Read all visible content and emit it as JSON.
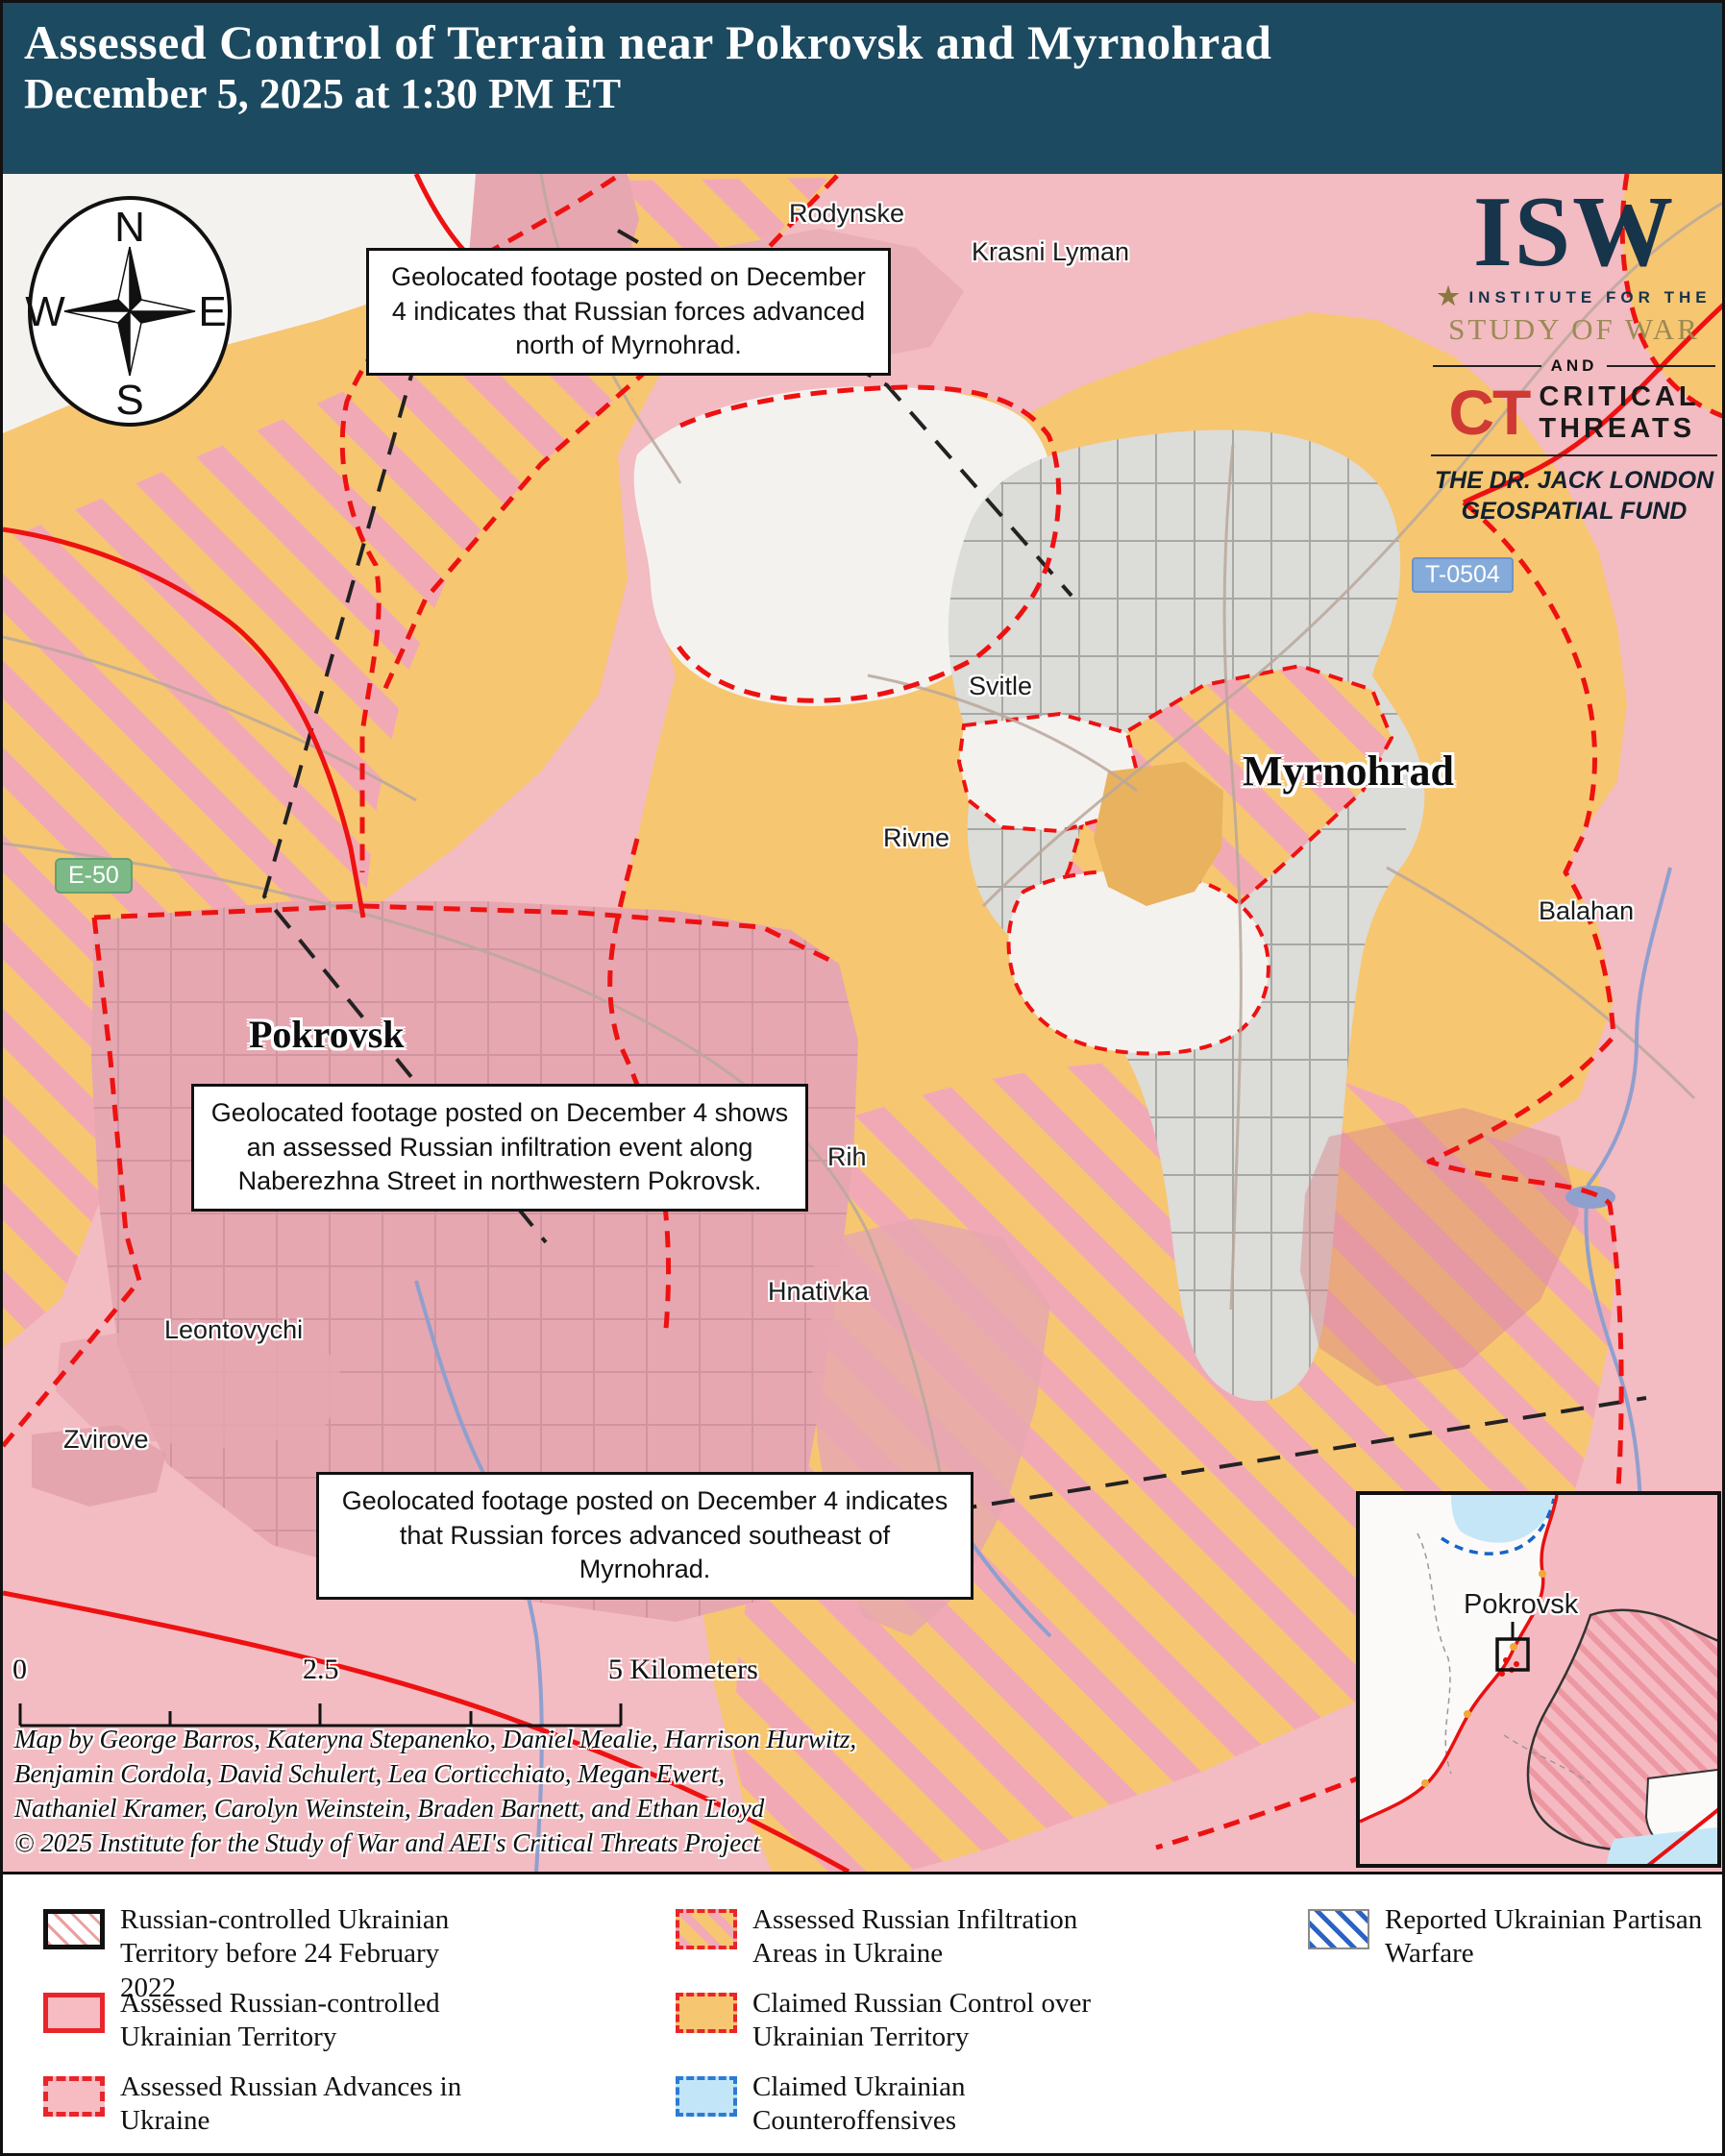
{
  "header": {
    "title_line1": "Assessed Control of Terrain near Pokrovsk and Myrnohrad",
    "title_line2": "December 5, 2025 at 1:30 PM ET"
  },
  "logo": {
    "isw": "ISW",
    "star": "★",
    "institute": "INSTITUTE FOR THE",
    "study_of_war": "STUDY OF WAR",
    "and": "AND",
    "ct": "CT",
    "critical_threats_line1": "CRITICAL",
    "critical_threats_line2": "THREATS",
    "fund_line1": "THE DR. JACK LONDON",
    "fund_line2": "GEOSPATIAL FUND"
  },
  "compass": {
    "n": "N",
    "e": "E",
    "s": "S",
    "w": "W"
  },
  "annotations": {
    "north": "Geolocated footage posted on December 4 indicates that Russian forces advanced north of Myrnohrad.",
    "infiltration": "Geolocated footage posted on December 4 shows an assessed Russian infiltration event along Naberezhna Street in northwestern Pokrovsk.",
    "southeast": "Geolocated footage posted on December 4 indicates that Russian forces advanced southeast of Myrnohrad."
  },
  "badges": {
    "e50": "E-50",
    "t0504": "T-0504"
  },
  "places": {
    "rodynske": "Rodynske",
    "krasni_lyman": "Krasni Lyman",
    "svitle": "Svitle",
    "myrnohrad": "Myrnohrad",
    "rivne": "Rivne",
    "balahan": "Balahan",
    "pokrovsk": "Pokrovsk",
    "rih": "Rih",
    "hnativka": "Hnativka",
    "leontovychi": "Leontovychi",
    "zvirove": "Zvirove"
  },
  "inset": {
    "label": "Pokrovsk"
  },
  "scalebar": {
    "zero": "0",
    "mid": "2.5",
    "end": "5 Kilometers"
  },
  "credits": {
    "line1": "Map by George Barros, Kateryna Stepanenko, Daniel Mealie, Harrison Hurwitz,",
    "line2": "Benjamin Cordola, David Schulert, Lea Corticchiato, Megan Ewert,",
    "line3": "Nathaniel Kramer, Carolyn Weinstein, Braden Barnett, and Ethan Lloyd",
    "line4": "© 2025 Institute for the Study of War and AEI's Critical Threats Project"
  },
  "legend": {
    "items": [
      {
        "label": "Russian-controlled Ukrainian Territory before 24 February 2022"
      },
      {
        "label": "Assessed Russian-controlled Ukrainian Territory"
      },
      {
        "label": "Assessed Russian Advances in Ukraine"
      },
      {
        "label": "Assessed Russian Infiltration Areas in Ukraine"
      },
      {
        "label": "Claimed Russian Control over Ukrainian Territory"
      },
      {
        "label": "Claimed Ukrainian Counteroffensives"
      },
      {
        "label": "Reported Ukrainian Partisan Warfare"
      }
    ]
  },
  "colors": {
    "header_bg": "#1c4a60",
    "russian_controlled_pink": "#f3bbc2",
    "claimed_orange": "#f7c671",
    "infiltration_stripe_pink": "#f2a9b6",
    "advance_red": "#ee1111",
    "counteroffensive_blue": "#2b7bd4",
    "urban_gray": "#dcdcd8",
    "road_badge_green": "#7cb987",
    "road_badge_blue": "#85abdb"
  }
}
